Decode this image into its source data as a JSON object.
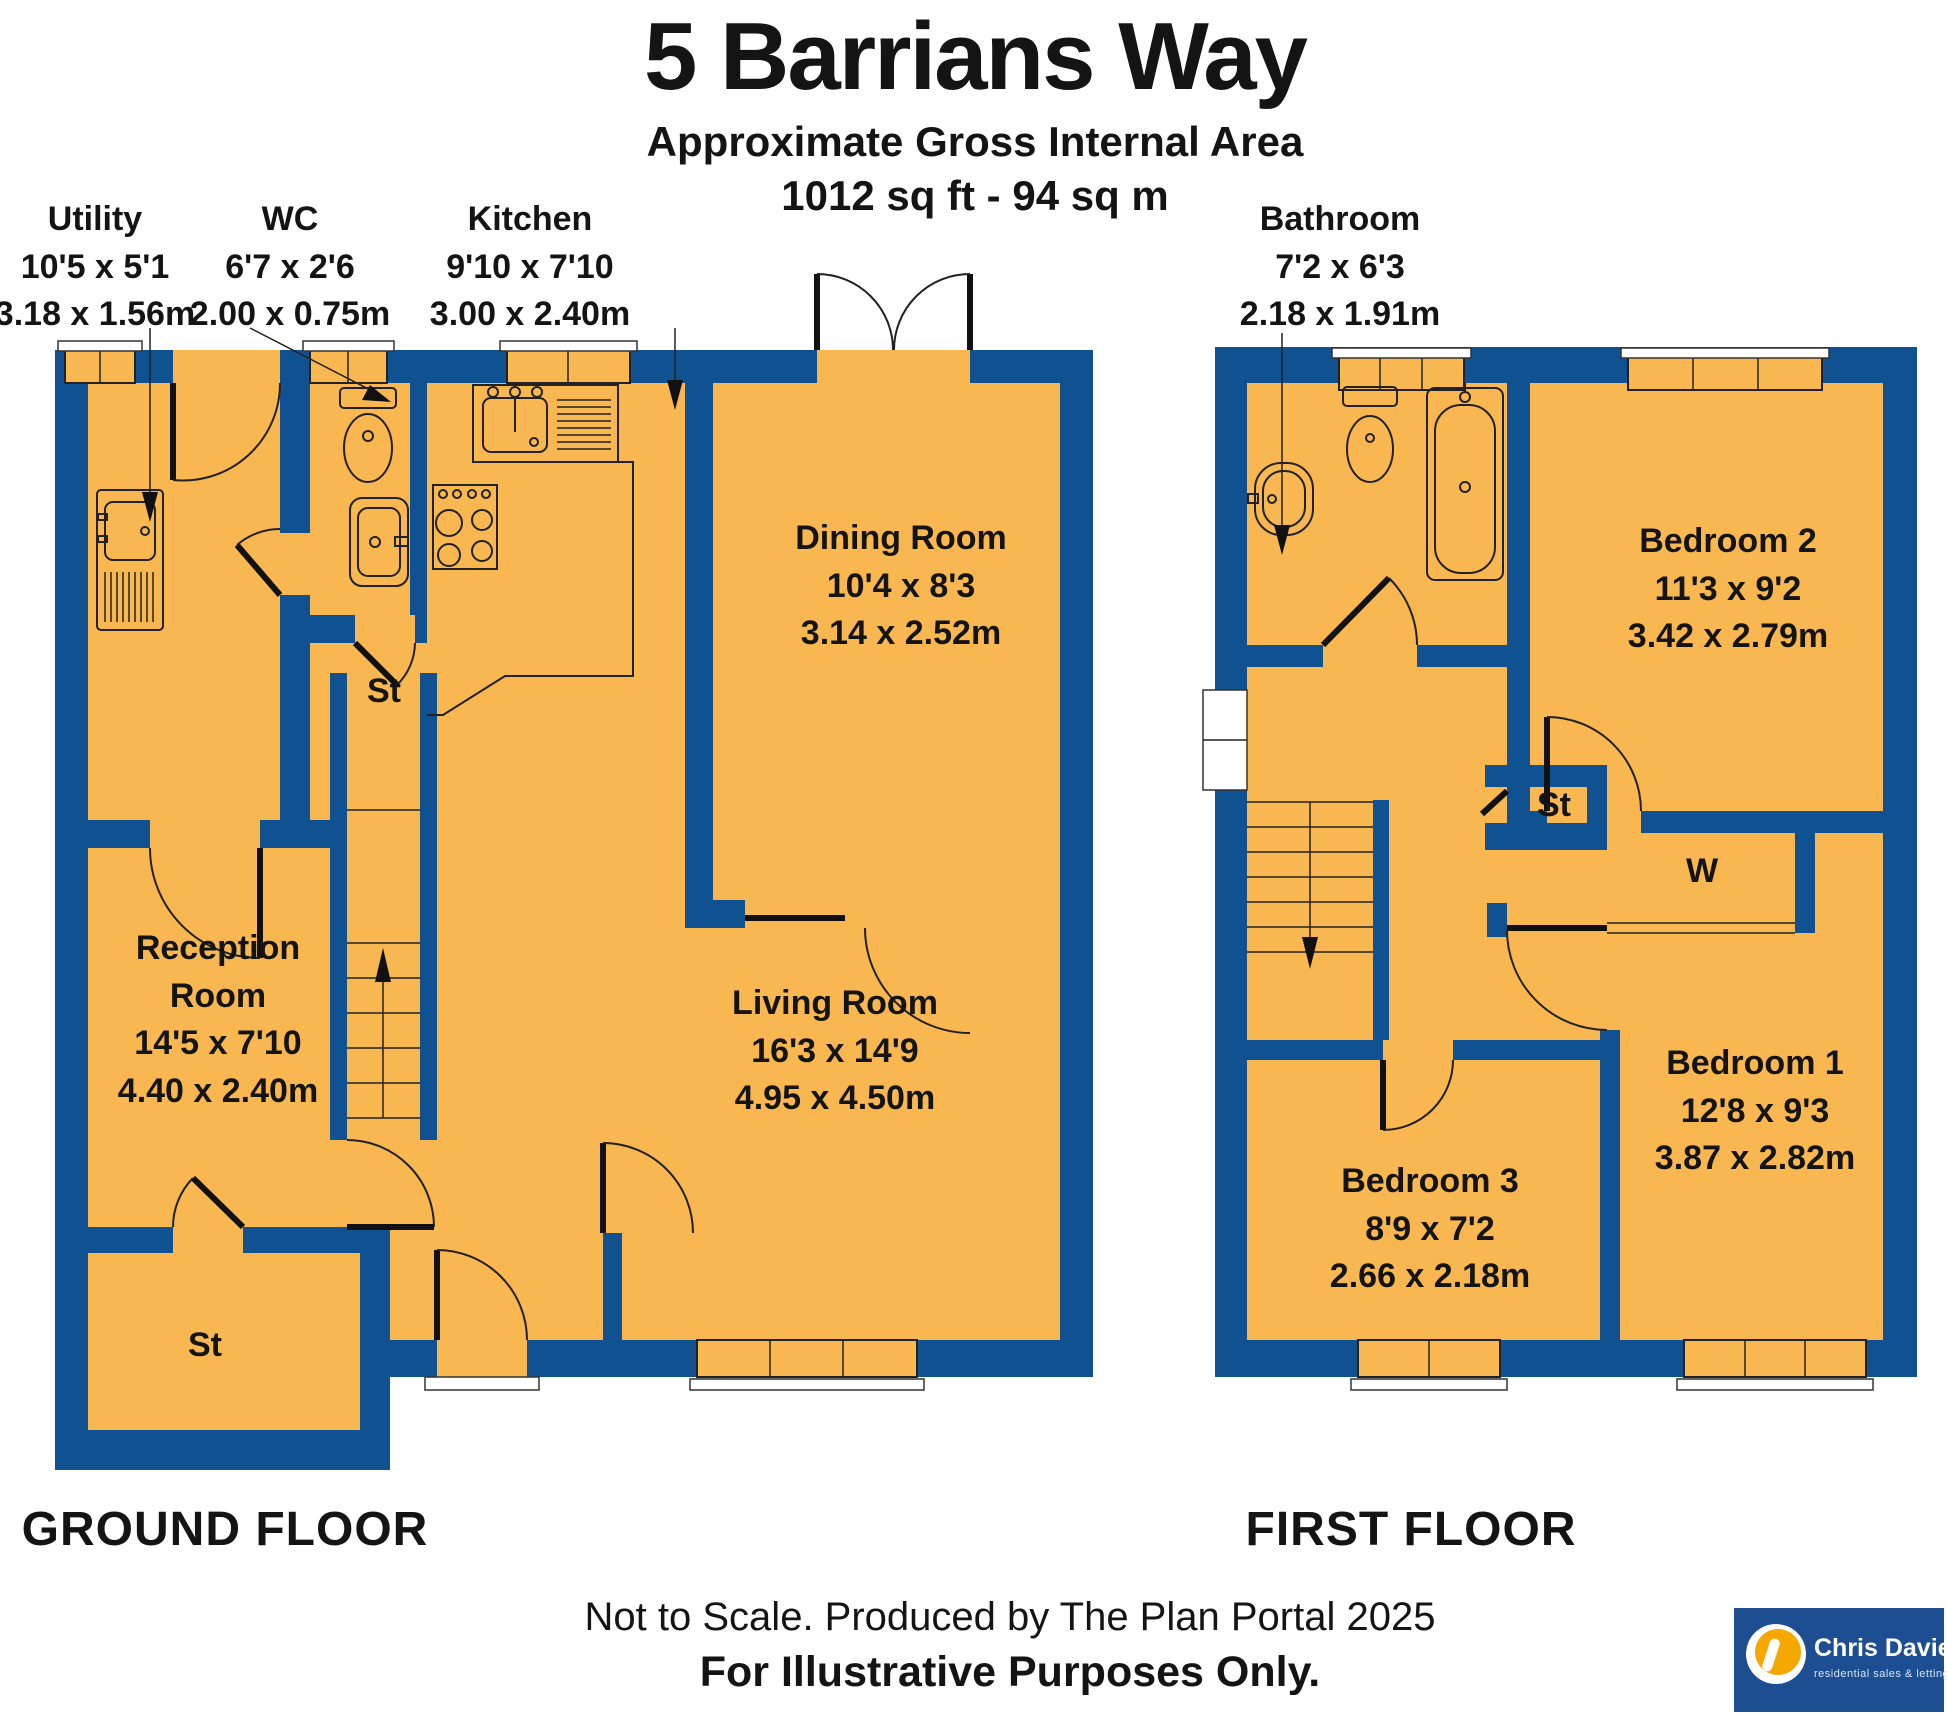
{
  "title": {
    "address": "5 Barrians Way",
    "subtitle": "Approximate Gross Internal Area",
    "area": "1012 sq ft - 94 sq m"
  },
  "floors": {
    "ground": {
      "label": "GROUND FLOOR"
    },
    "first": {
      "label": "FIRST FLOOR"
    }
  },
  "rooms": {
    "utility": {
      "name": "Utility",
      "imperial": "10'5 x 5'1",
      "metric": "3.18 x 1.56m"
    },
    "wc": {
      "name": "WC",
      "imperial": "6'7 x 2'6",
      "metric": "2.00 x 0.75m"
    },
    "kitchen": {
      "name": "Kitchen",
      "imperial": "9'10 x 7'10",
      "metric": "3.00 x 2.40m"
    },
    "dining": {
      "name": "Dining Room",
      "imperial": "10'4 x 8'3",
      "metric": "3.14 x 2.52m"
    },
    "living": {
      "name": "Living Room",
      "imperial": "16'3 x 14'9",
      "metric": "4.95 x 4.50m"
    },
    "reception": {
      "name": "Reception Room",
      "imperial": "14'5 x 7'10",
      "metric": "4.40 x 2.40m"
    },
    "bathroom": {
      "name": "Bathroom",
      "imperial": "7'2 x 6'3",
      "metric": "2.18 x 1.91m"
    },
    "bedroom1": {
      "name": "Bedroom 1",
      "imperial": "12'8 x 9'3",
      "metric": "3.87 x 2.82m"
    },
    "bedroom2": {
      "name": "Bedroom 2",
      "imperial": "11'3 x 9'2",
      "metric": "3.42 x 2.79m"
    },
    "bedroom3": {
      "name": "Bedroom 3",
      "imperial": "8'9 x 7'2",
      "metric": "2.66 x 2.18m"
    }
  },
  "annotations": {
    "storage": "St",
    "wardrobe": "W"
  },
  "footer": {
    "line1": "Not to Scale. Produced by The Plan Portal 2025",
    "line2": "For Illustrative Purposes Only."
  },
  "logo": {
    "name": "Chris Davies",
    "tagline": "residential sales & lettings"
  },
  "colors": {
    "wall": "#0f5191",
    "floor": "#f8b750",
    "logo_bg": "#1c4e91",
    "logo_accent": "#f5a800"
  }
}
